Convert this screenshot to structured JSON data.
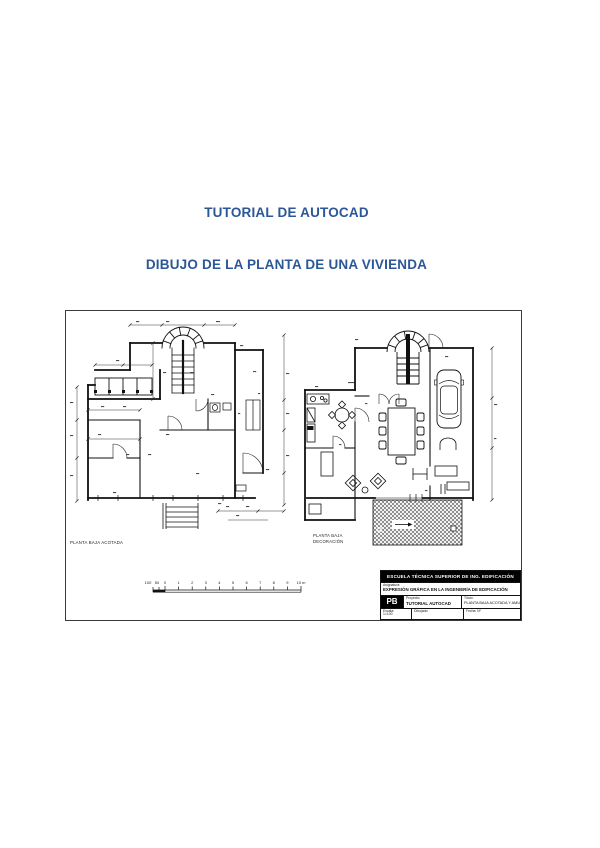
{
  "page": {
    "title1": "TUTORIAL DE AUTOCAD",
    "title2": "DIBUJO DE LA PLANTA DE UNA VIVIENDA",
    "accent_color": "#2b5797"
  },
  "drawing": {
    "left_plan": {
      "label": "PLANTA BAJA ACOTADA"
    },
    "right_plan": {
      "label_line1": "PLANTA BAJA",
      "label_line2": "DECORACIÓN"
    },
    "scalebar": {
      "labels": [
        "100",
        "50",
        "0",
        "1",
        "2",
        "3",
        "4",
        "5",
        "6",
        "7",
        "8",
        "9",
        "10 m"
      ]
    },
    "titleblock": {
      "school": "ESCUELA TÉCNICA SUPERIOR DE ING. EDIFICACIÓN",
      "asignatura_label": "Asignatura:",
      "asignatura": "EXPRESIÓN GRÁFICA EN LA INGENIERÍA DE EDIFICACIÓN",
      "sheet_code": "PB",
      "proyecto_label": "Proyecto:",
      "proyecto": "TUTORIAL AUTOCAD",
      "titulo_label": "Título:",
      "titulo": "PLANTA BAJA ACOTADA Y AMUEBLADA",
      "escala_label": "Escala:",
      "escala": "1=100",
      "dibujado_label": "Dibujado:",
      "fecha_label": "Fecha: Nº"
    }
  }
}
